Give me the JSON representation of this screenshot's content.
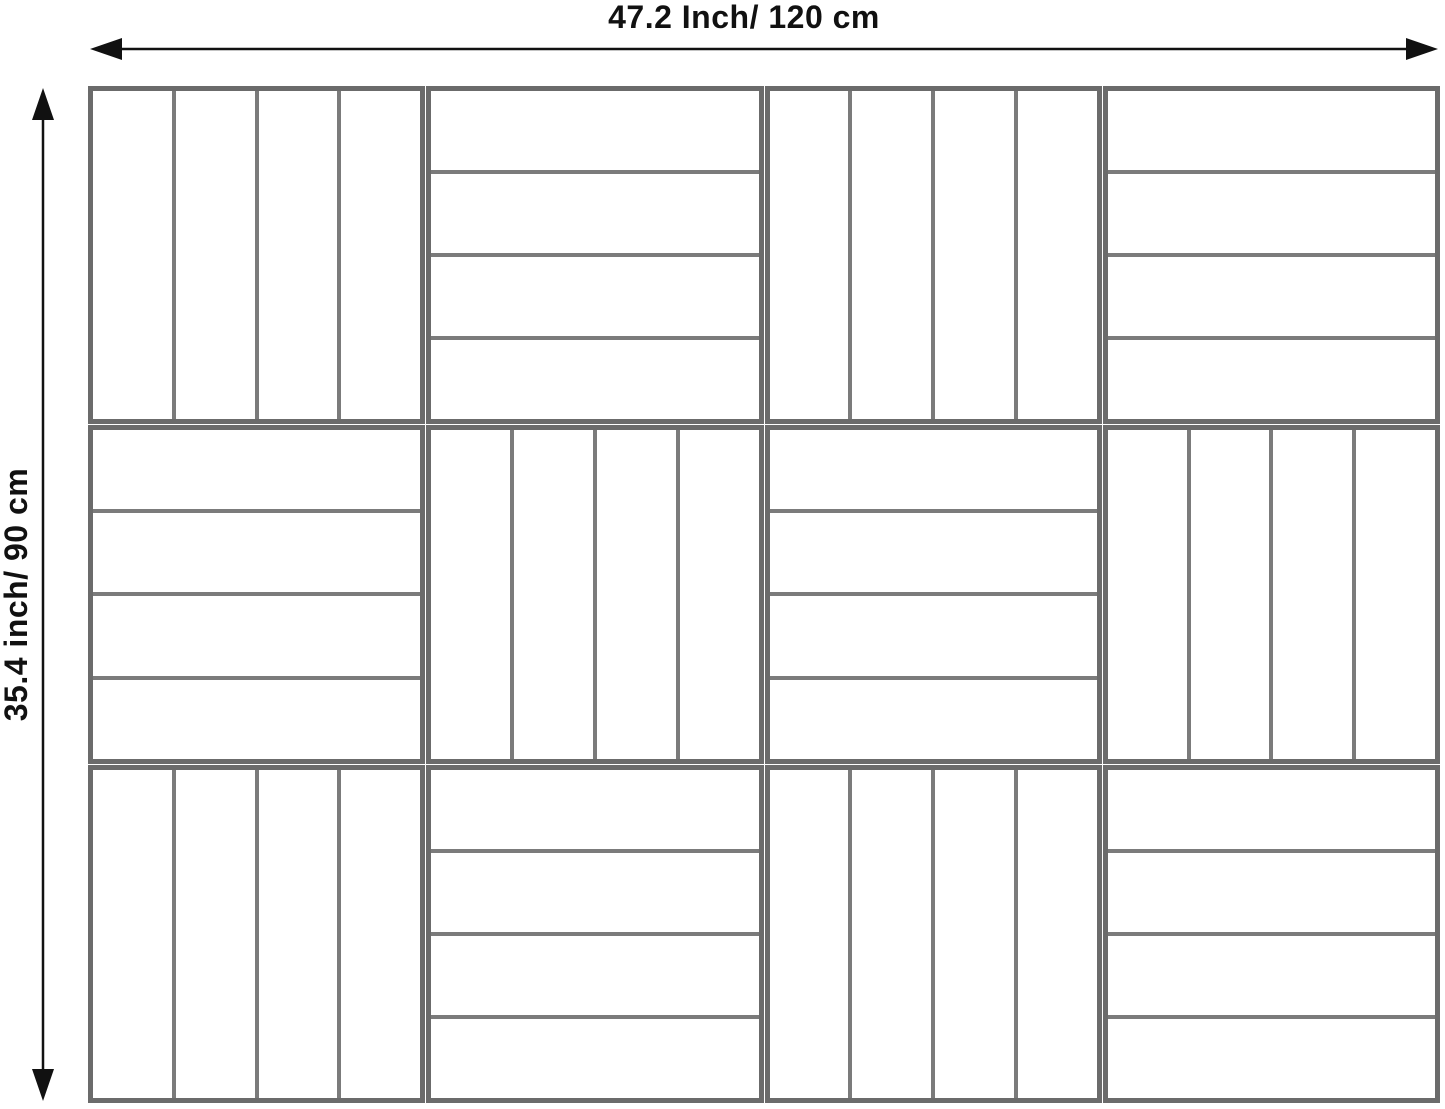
{
  "diagram": {
    "width_label": "47.2 Inch/ 120 cm",
    "height_label": "35.4 inch/ 90 cm"
  },
  "panel": {
    "columns": 4,
    "rows": 3,
    "slats_per_tile": 4,
    "tiles": [
      {
        "row": 1,
        "col": 1,
        "orientation": "vertical"
      },
      {
        "row": 1,
        "col": 2,
        "orientation": "horizontal"
      },
      {
        "row": 1,
        "col": 3,
        "orientation": "vertical"
      },
      {
        "row": 1,
        "col": 4,
        "orientation": "horizontal"
      },
      {
        "row": 2,
        "col": 1,
        "orientation": "horizontal"
      },
      {
        "row": 2,
        "col": 2,
        "orientation": "vertical"
      },
      {
        "row": 2,
        "col": 3,
        "orientation": "horizontal"
      },
      {
        "row": 2,
        "col": 4,
        "orientation": "vertical"
      },
      {
        "row": 3,
        "col": 1,
        "orientation": "vertical"
      },
      {
        "row": 3,
        "col": 2,
        "orientation": "horizontal"
      },
      {
        "row": 3,
        "col": 3,
        "orientation": "vertical"
      },
      {
        "row": 3,
        "col": 4,
        "orientation": "horizontal"
      }
    ]
  },
  "icons": {
    "arrow_left": "◀",
    "arrow_right": "▶",
    "arrow_up": "▲",
    "arrow_down": "▼"
  },
  "colors": {
    "tile_border": "#6b6b6b",
    "slat_divider": "#7b7b7b",
    "arrow": "#111111",
    "background": "#ffffff",
    "slat_fill": "#ffffff",
    "label_color": "#111111"
  }
}
